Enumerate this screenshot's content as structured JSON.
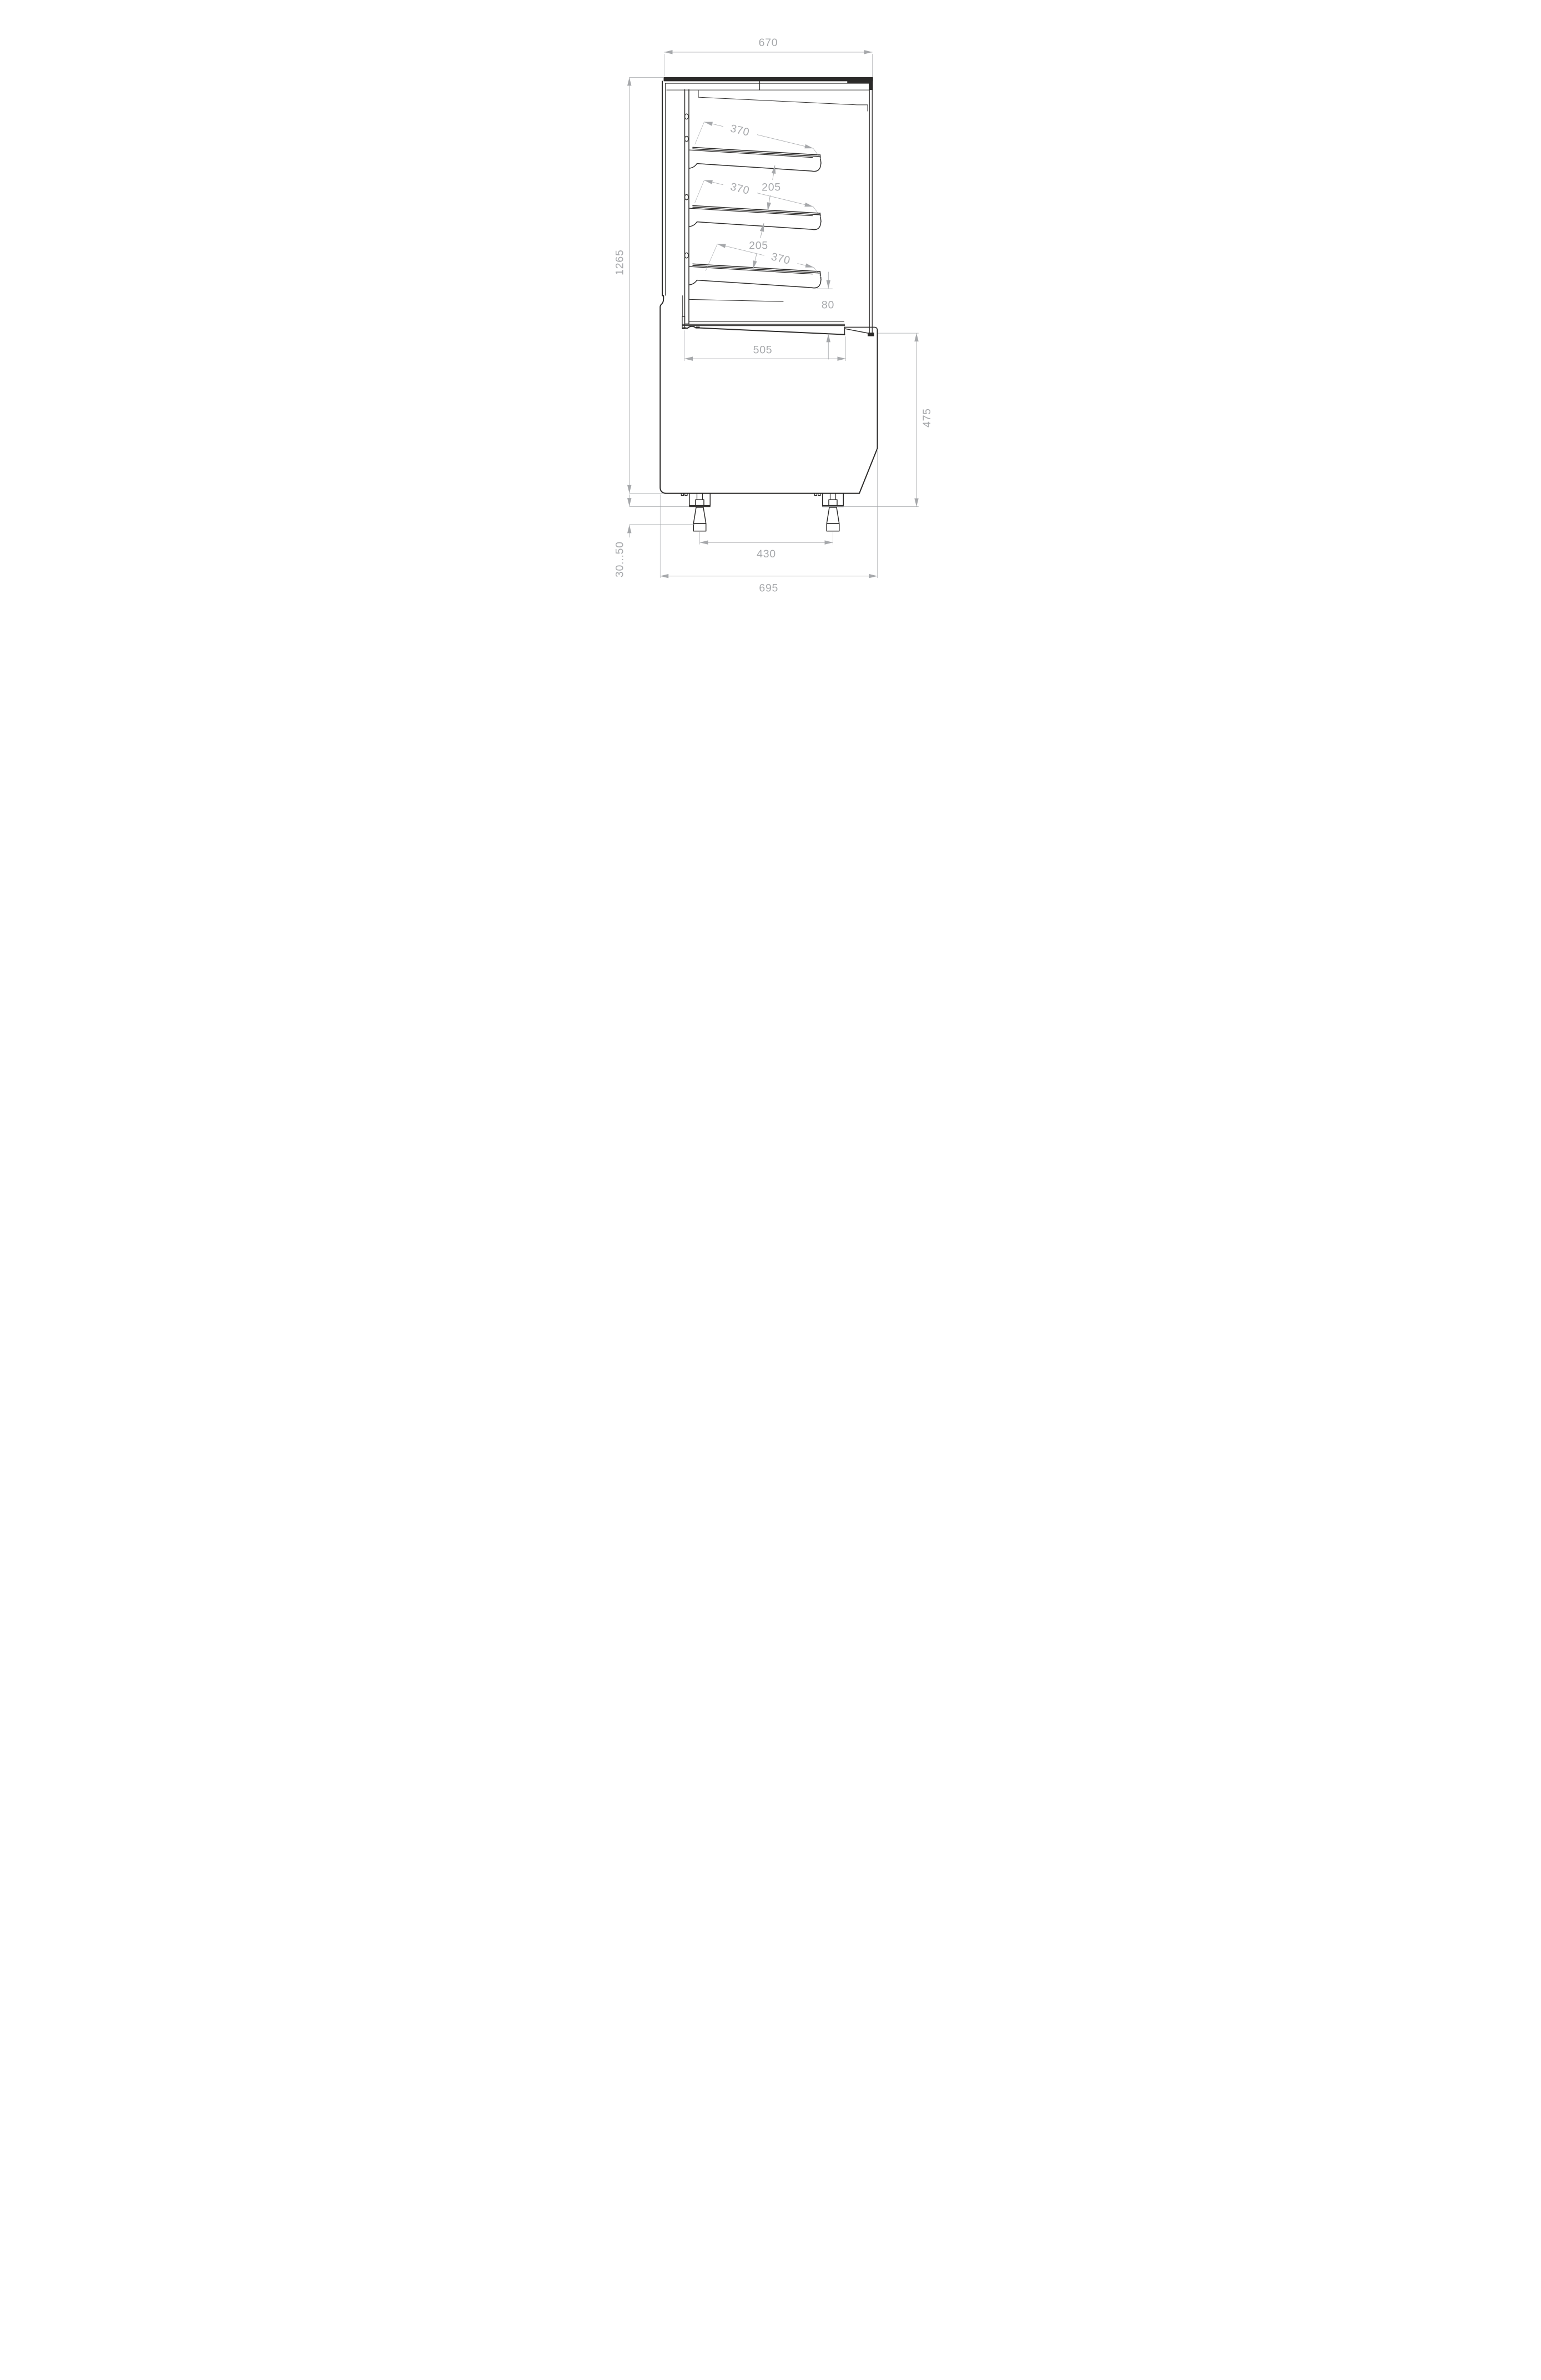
{
  "drawing": {
    "kind": "technical-section-side-view",
    "subject": "display case with three sloped shelves, deck and adjustable feet",
    "colors": {
      "line": "#2b2a29",
      "dimension": "#a6a8ab",
      "background": "#ffffff"
    },
    "dimensions": {
      "top_width": "670",
      "shelf_depth": "370",
      "shelf_gap": "205",
      "total_height": "1265",
      "deck_clearance": "80",
      "deck_depth": "505",
      "base_height": "475",
      "feet_spacing": "430",
      "overall_depth": "695",
      "foot_adjust_range": "30...50"
    }
  }
}
